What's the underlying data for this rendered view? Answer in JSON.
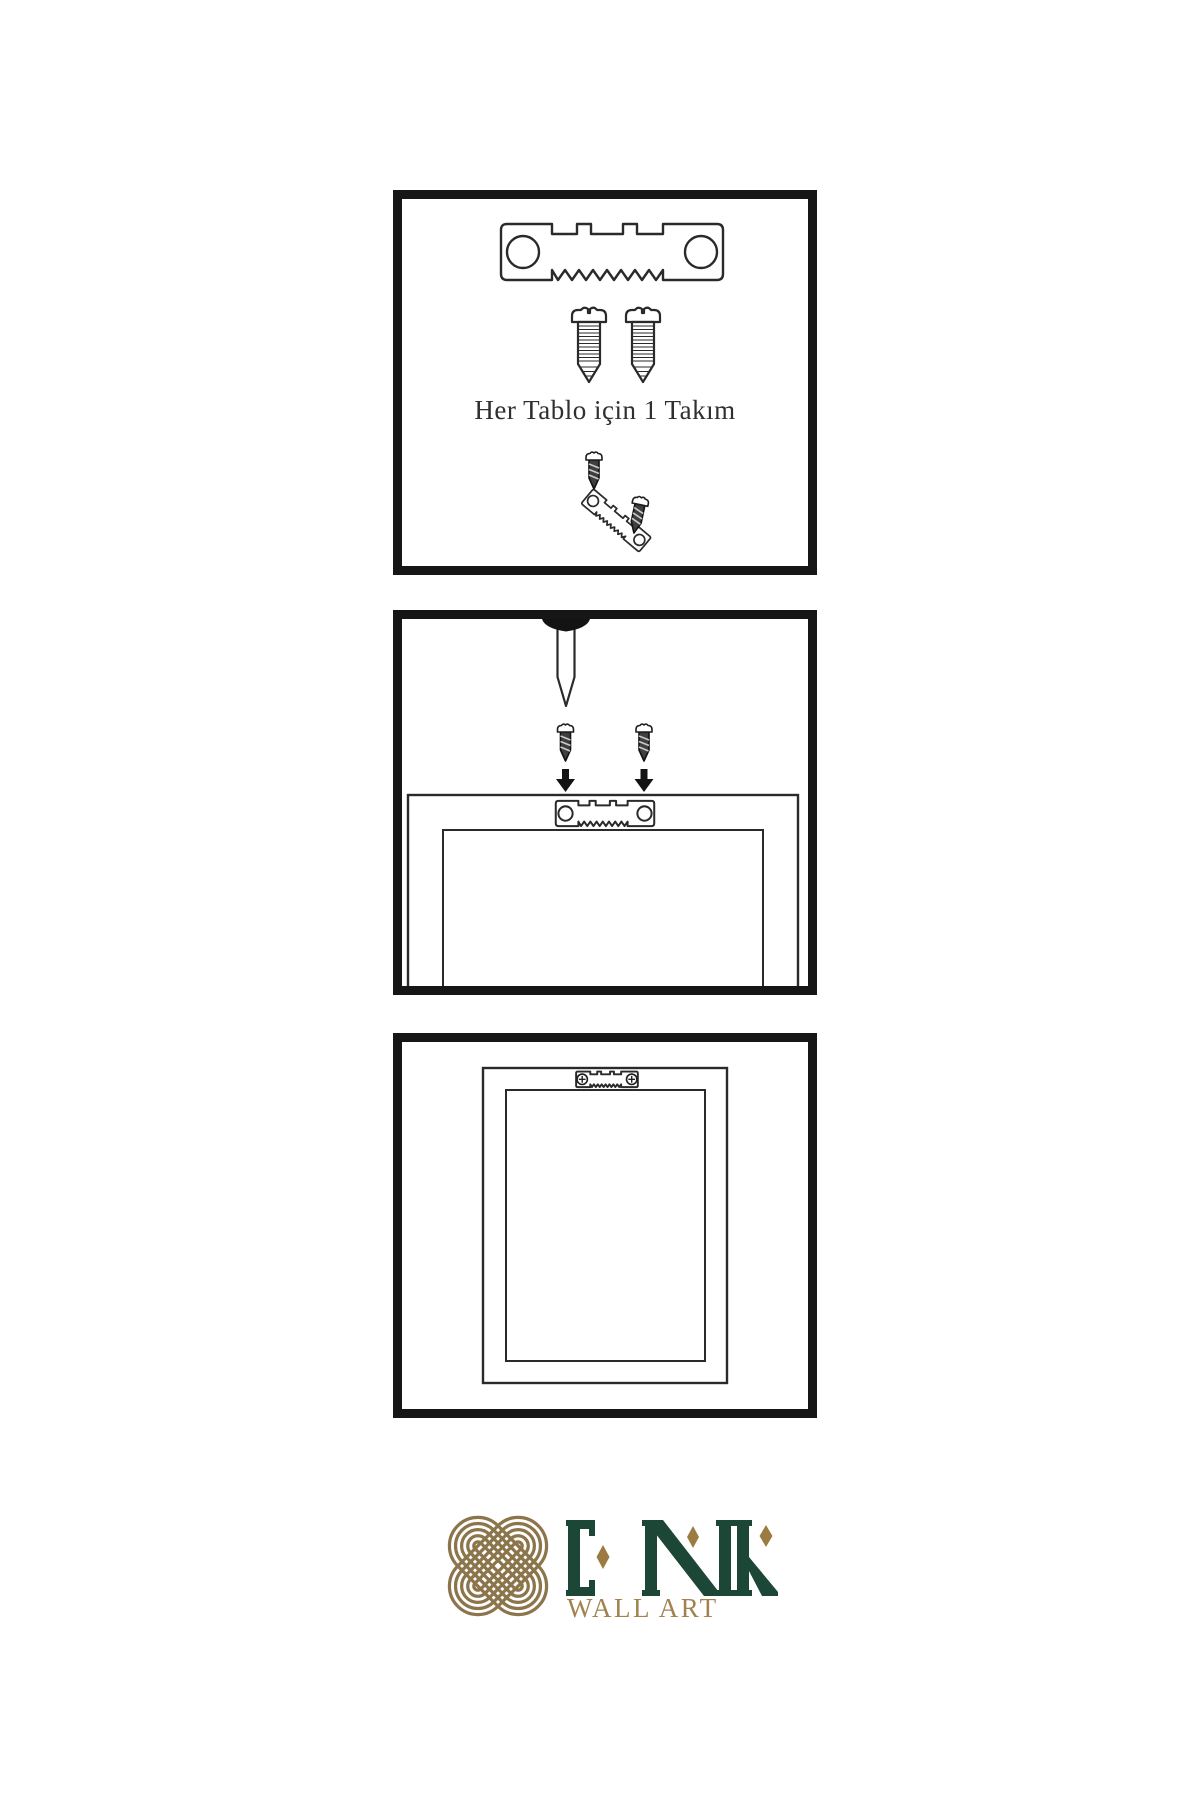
{
  "instructions": {
    "step1_caption": "Her Tablo için 1 Takım"
  },
  "logo": {
    "brand": "ENK",
    "tagline": "WALL ART"
  },
  "icons": {
    "hanger": "sawtooth-hanger",
    "screw_light": "mounting-screw",
    "screw_dark": "driven-screw",
    "nail": "wall-nail",
    "arrow": "arrow-down",
    "frame_back": "frame-back-view",
    "frame_front": "hung-picture-frame",
    "logo_knot": "interlaced-knot"
  },
  "colors": {
    "ink": "#2a2a2a",
    "panel_border": "#161616",
    "screw_dark": "#3f3f3f",
    "brand_green": "#1c4636",
    "brand_gold": "#9b7b41",
    "knot_gold": "#8c754a",
    "tagline_gold": "#a28350"
  }
}
